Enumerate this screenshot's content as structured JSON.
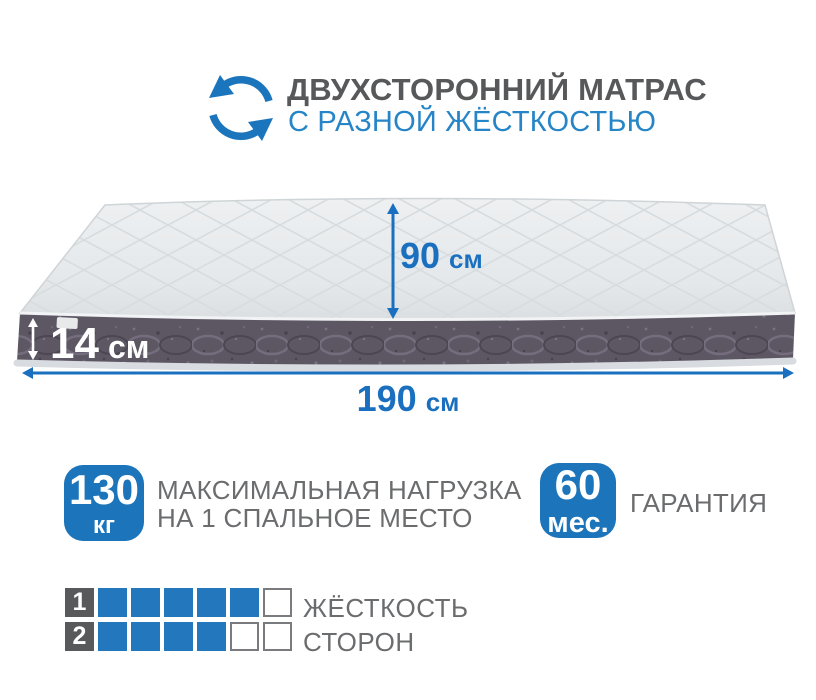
{
  "header": {
    "title": "ДВУХСТОРОННИЙ МАТРАС",
    "subtitle": "С РАЗНОЙ ЖЁСТКОСТЬЮ",
    "icon": "rotate-arrows-icon"
  },
  "dimensions": {
    "height": {
      "value": "14",
      "unit": "см"
    },
    "width": {
      "value": "90",
      "unit": "см"
    },
    "length": {
      "value": "190",
      "unit": "см"
    }
  },
  "features": {
    "max_load": {
      "value": "130",
      "unit": "кг",
      "caption_line1": "МАКСИМАЛЬНАЯ НАГРУЗКА",
      "caption_line2": "НА 1 СПАЛЬНОЕ МЕСТО"
    },
    "warranty": {
      "value": "60",
      "unit": "мес.",
      "caption": "ГАРАНТИЯ"
    }
  },
  "hardness_scale": {
    "rows": [
      {
        "label": "1",
        "filled": 5,
        "total": 6
      },
      {
        "label": "2",
        "filled": 4,
        "total": 6
      }
    ],
    "caption_line1": "ЖЁСТКОСТЬ",
    "caption_line2": "СТОРОН"
  },
  "colors": {
    "accent_blue": "#1c74ba",
    "dimension_blue": "#1a70bf",
    "subtitle_blue": "#2585c7",
    "title_gray": "#57585a",
    "text_gray": "#6b6c6e",
    "scale_blue": "#2378bd",
    "scale_label_gray": "#58595b",
    "mattress_side": "#5d5764",
    "mattress_top": "#e9eced"
  }
}
